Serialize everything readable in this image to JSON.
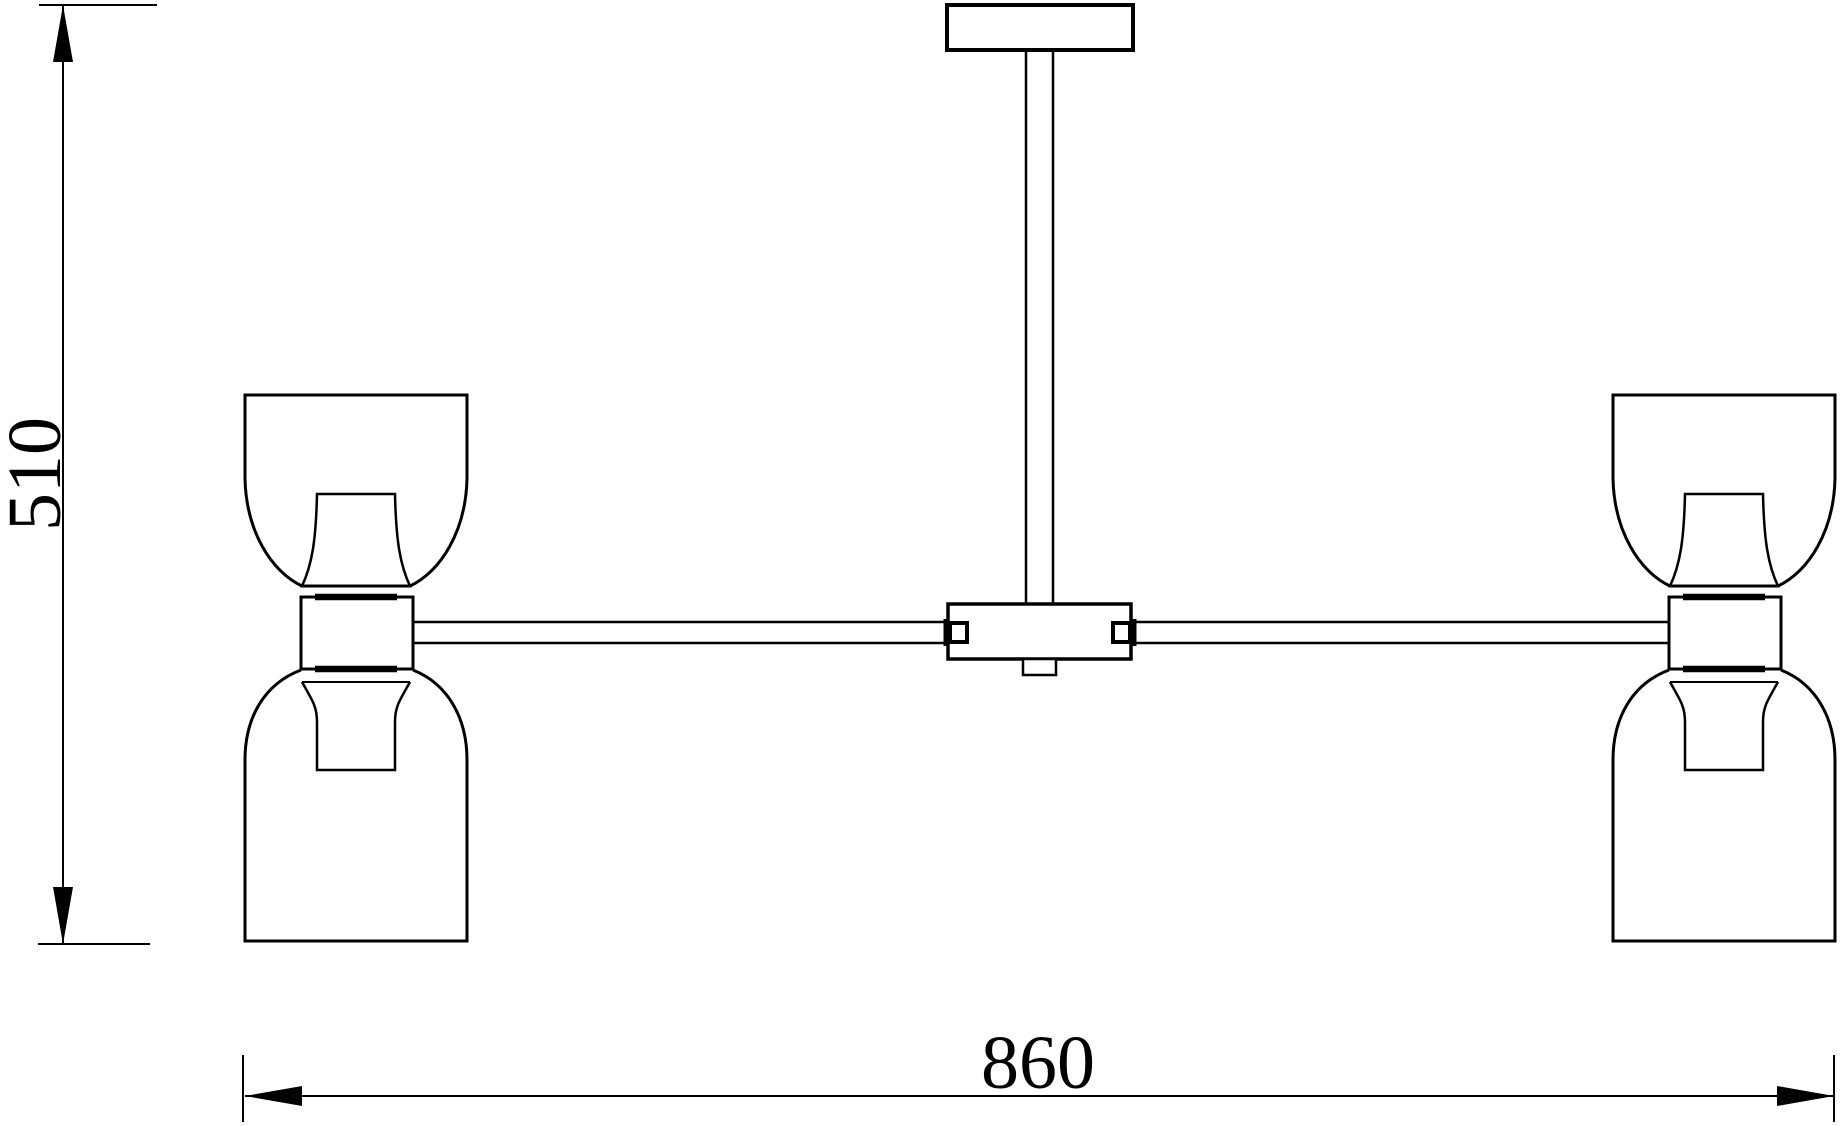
{
  "drawing": {
    "type": "technical-line-drawing",
    "background_color": "#ffffff",
    "line_color": "#000000",
    "dimensions": {
      "height": {
        "label": "510"
      },
      "width": {
        "label": "860"
      }
    }
  }
}
